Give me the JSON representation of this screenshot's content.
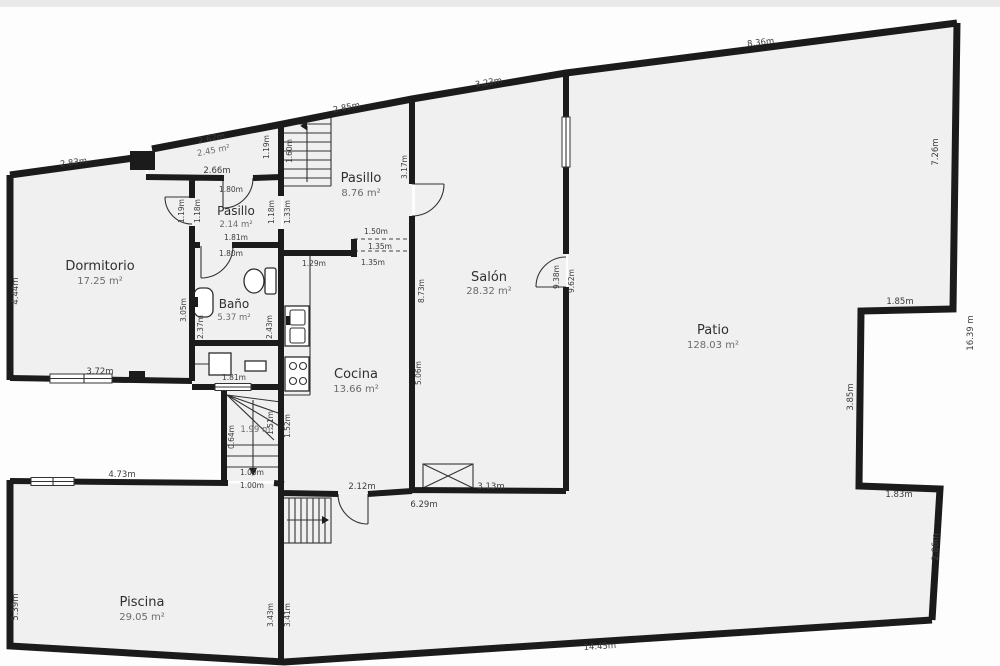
{
  "plan_type": "floor-plan",
  "rooms": [
    {
      "name": "Dormitorio",
      "area": "17.25 m²"
    },
    {
      "name": "Pasillo",
      "area": "2.14 m²"
    },
    {
      "name": "Baño",
      "area": "5.37 m²"
    },
    {
      "name": "Pasillo",
      "area": "8.76 m²"
    },
    {
      "name": "Cocina",
      "area": "13.66 m²"
    },
    {
      "name": "Salón",
      "area": "28.32 m²"
    },
    {
      "name": "Patio",
      "area": "128.03 m²"
    },
    {
      "name": "Piscina",
      "area": "29.05 m²"
    },
    {
      "name": "",
      "area": "2.45 m²"
    },
    {
      "name": "",
      "area": "1.99 m²"
    }
  ],
  "dims": [
    {
      "label": "2.83m"
    },
    {
      "label": "2.62m"
    },
    {
      "label": "2.66m"
    },
    {
      "label": "2.85m"
    },
    {
      "label": "3.23m"
    },
    {
      "label": "8.36m"
    },
    {
      "label": "7.26m"
    },
    {
      "label": "1.85m"
    },
    {
      "label": "3.85m"
    },
    {
      "label": "1.83m"
    },
    {
      "label": "2.86m"
    },
    {
      "label": "14.45m"
    },
    {
      "label": "16.39 m"
    },
    {
      "label": "5.39m"
    },
    {
      "label": "4.73m"
    },
    {
      "label": "3.72m"
    },
    {
      "label": "4.44m"
    },
    {
      "label": "3.05m"
    },
    {
      "label": "1.19m"
    },
    {
      "label": "1.18m"
    },
    {
      "label": "1.81m"
    },
    {
      "label": "1.80m"
    },
    {
      "label": "1.80m"
    },
    {
      "label": "2.37m"
    },
    {
      "label": "1.81m"
    },
    {
      "label": "2.43m"
    },
    {
      "label": "1.19m"
    },
    {
      "label": "1.60m"
    },
    {
      "label": "1.18m"
    },
    {
      "label": "1.33m"
    },
    {
      "label": "3.17m"
    },
    {
      "label": "1.50m"
    },
    {
      "label": "1.35m"
    },
    {
      "label": "1.35m"
    },
    {
      "label": "1.29m"
    },
    {
      "label": "8.73m"
    },
    {
      "label": "5.06m"
    },
    {
      "label": "9.38m"
    },
    {
      "label": "9.62m"
    },
    {
      "label": "2.12m"
    },
    {
      "label": "6.29m"
    },
    {
      "label": "3.13m"
    },
    {
      "label": "1.51m"
    },
    {
      "label": "0.64m"
    },
    {
      "label": "1.52m"
    },
    {
      "label": "1.00m"
    },
    {
      "label": "1.00m"
    },
    {
      "label": "3.43m"
    },
    {
      "label": "3.41m"
    }
  ],
  "colors": {
    "wall": "#1b1b1b",
    "room_fill": "#f0f0f0",
    "dim_text": "#3c3c3c"
  }
}
